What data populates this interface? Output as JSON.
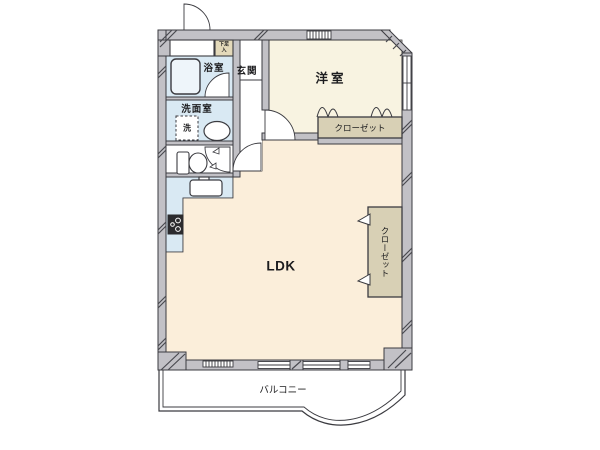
{
  "rooms": {
    "western_room": "洋室",
    "entrance": "玄関",
    "bathroom": "浴室",
    "washroom": "洗面室",
    "washer": "洗",
    "ldk": "LDK",
    "closet_west": "クローゼット",
    "closet_ldk": "クローゼット",
    "balcony": "バルコニー",
    "shoe_cabinet_line1": "下足",
    "shoe_cabinet_line2": "入"
  },
  "colors": {
    "wall_fill": "#c2c1c6",
    "wall_outline": "#3b3b40",
    "western_room_floor": "#f8f3e1",
    "ldk_floor": "#fbeeda",
    "wet_area_floor": "#d9e9f3",
    "closet_fill": "#d8d0b5",
    "shoe_cabinet_fill": "#e3d9ba",
    "toilet_floor": "#ffffff",
    "balcony_floor": "#ffffff",
    "stove_fill": "#2b2b2e",
    "line": "#3b3b40"
  }
}
